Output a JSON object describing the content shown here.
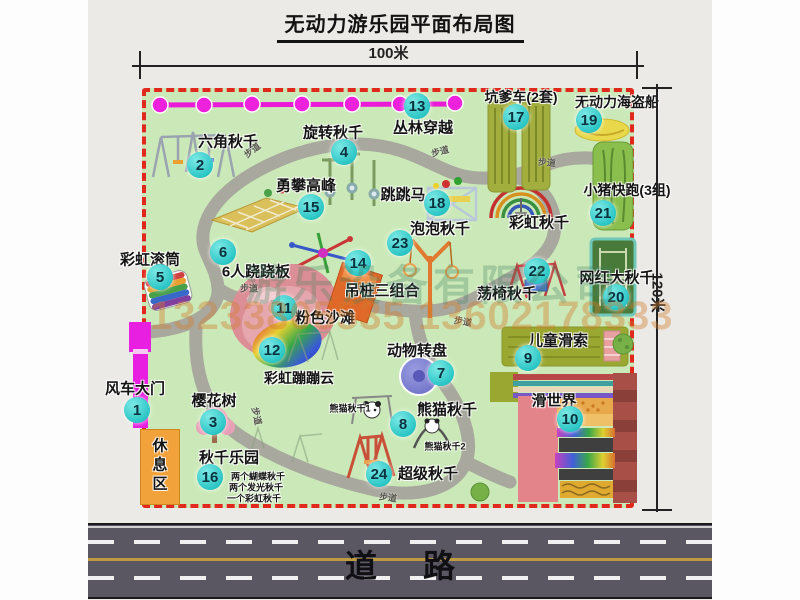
{
  "title": "无动力游乐园平面布局图",
  "scale": {
    "width_label": "100米",
    "height_label": "120米"
  },
  "road": {
    "label": "道路"
  },
  "watermark": {
    "company": "游乐设备有限公司",
    "phone": "13233805535 13602178333"
  },
  "path_label_text": "步道",
  "colors": {
    "park_green": "#cbe9b8",
    "border_red": "#e0281c",
    "badge_cyan": "#2cc6c6",
    "gate_magenta": "#e81ee0",
    "path_gray": "#a8a89e",
    "road_gray": "#5a5762"
  },
  "attractions": [
    {
      "num": "1",
      "name": "风车大门",
      "lx": 135,
      "ly": 388,
      "bx": 137,
      "by": 410
    },
    {
      "num": "2",
      "name": "六角秋千",
      "lx": 228,
      "ly": 141,
      "bx": 200,
      "by": 165
    },
    {
      "num": "3",
      "name": "樱花树",
      "lx": 214,
      "ly": 400,
      "bx": 213,
      "by": 422
    },
    {
      "num": "4",
      "name": "旋转秋千",
      "lx": 333,
      "ly": 132,
      "bx": 344,
      "by": 152
    },
    {
      "num": "5",
      "name": "彩虹滚筒",
      "lx": 150,
      "ly": 259,
      "bx": 160,
      "by": 277
    },
    {
      "num": "6",
      "name": "6人跷跷板",
      "lx": 256,
      "ly": 271,
      "bx": 223,
      "by": 252
    },
    {
      "num": "7",
      "name": "动物转盘",
      "lx": 417,
      "ly": 350,
      "bx": 441,
      "by": 373
    },
    {
      "num": "8",
      "name": "熊猫秋千",
      "lx": 447,
      "ly": 409,
      "bx": 403,
      "by": 424
    },
    {
      "num": "9",
      "name": "儿童滑索",
      "lx": 558,
      "ly": 340,
      "bx": 528,
      "by": 358
    },
    {
      "num": "10",
      "name": "滑世界",
      "lx": 554,
      "ly": 400,
      "bx": 570,
      "by": 419
    },
    {
      "num": "11",
      "name": "粉色沙滩",
      "lx": 325,
      "ly": 317,
      "bx": 284,
      "by": 308
    },
    {
      "num": "12",
      "name": "彩虹蹦蹦云",
      "lx": 299,
      "ly": 378,
      "bx": 272,
      "by": 350,
      "fs": 14
    },
    {
      "num": "13",
      "name": "丛林穿越",
      "lx": 423,
      "ly": 127,
      "bx": 417,
      "by": 106
    },
    {
      "num": "14",
      "name": "吊桩三组合",
      "lx": 382,
      "ly": 290,
      "bx": 358,
      "by": 263
    },
    {
      "num": "15",
      "name": "勇攀高峰",
      "lx": 306,
      "ly": 185,
      "bx": 311,
      "by": 207
    },
    {
      "num": "16",
      "name": "秋千乐园",
      "lx": 229,
      "ly": 457,
      "bx": 210,
      "by": 477
    },
    {
      "num": "17",
      "name": "坑爹车(2套)",
      "lx": 521,
      "ly": 97,
      "bx": 516,
      "by": 117,
      "fs": 14
    },
    {
      "num": "18",
      "name": "跳跳马",
      "lx": 403,
      "ly": 194,
      "bx": 437,
      "by": 203
    },
    {
      "num": "19",
      "name": "无动力海盗船",
      "lx": 617,
      "ly": 102,
      "bx": 589,
      "by": 120,
      "fs": 14
    },
    {
      "num": "20",
      "name": "网红大秋千",
      "lx": 617,
      "ly": 277,
      "bx": 616,
      "by": 297
    },
    {
      "num": "21",
      "name": "小猪快跑(3组)",
      "lx": 627,
      "ly": 190,
      "bx": 603,
      "by": 213,
      "fs": 14
    },
    {
      "num": "22",
      "name": "荡椅秋千",
      "lx": 507,
      "ly": 293,
      "bx": 537,
      "by": 271
    },
    {
      "num": "23",
      "name": "泡泡秋千",
      "lx": 440,
      "ly": 228,
      "bx": 400,
      "by": 243
    },
    {
      "num": "24",
      "name": "超级秋千",
      "lx": 428,
      "ly": 473,
      "bx": 379,
      "by": 474
    }
  ],
  "extra_labels": [
    {
      "text": "彩虹秋千",
      "x": 539,
      "y": 222,
      "size": 15
    },
    {
      "text": "熊猫秋千1",
      "x": 350,
      "y": 408,
      "size": 9
    },
    {
      "text": "熊猫秋千2",
      "x": 445,
      "y": 446,
      "size": 9
    },
    {
      "text": "两个蝴蝶秋千",
      "x": 258,
      "y": 476,
      "size": 9
    },
    {
      "text": "两个发光秋千",
      "x": 256,
      "y": 487,
      "size": 9
    },
    {
      "text": "一个彩虹秋千",
      "x": 254,
      "y": 498,
      "size": 9
    },
    {
      "text": "休息区",
      "x": 159,
      "y": 466,
      "size": 15,
      "vertical": true
    }
  ],
  "path_labels": [
    {
      "x": 252,
      "y": 150,
      "rot": -38
    },
    {
      "x": 440,
      "y": 151,
      "rot": -15
    },
    {
      "x": 547,
      "y": 162,
      "rot": 5
    },
    {
      "x": 249,
      "y": 288,
      "rot": 0
    },
    {
      "x": 257,
      "y": 416,
      "rot": 78
    },
    {
      "x": 388,
      "y": 497,
      "rot": 8
    },
    {
      "x": 463,
      "y": 321,
      "rot": 10
    }
  ]
}
